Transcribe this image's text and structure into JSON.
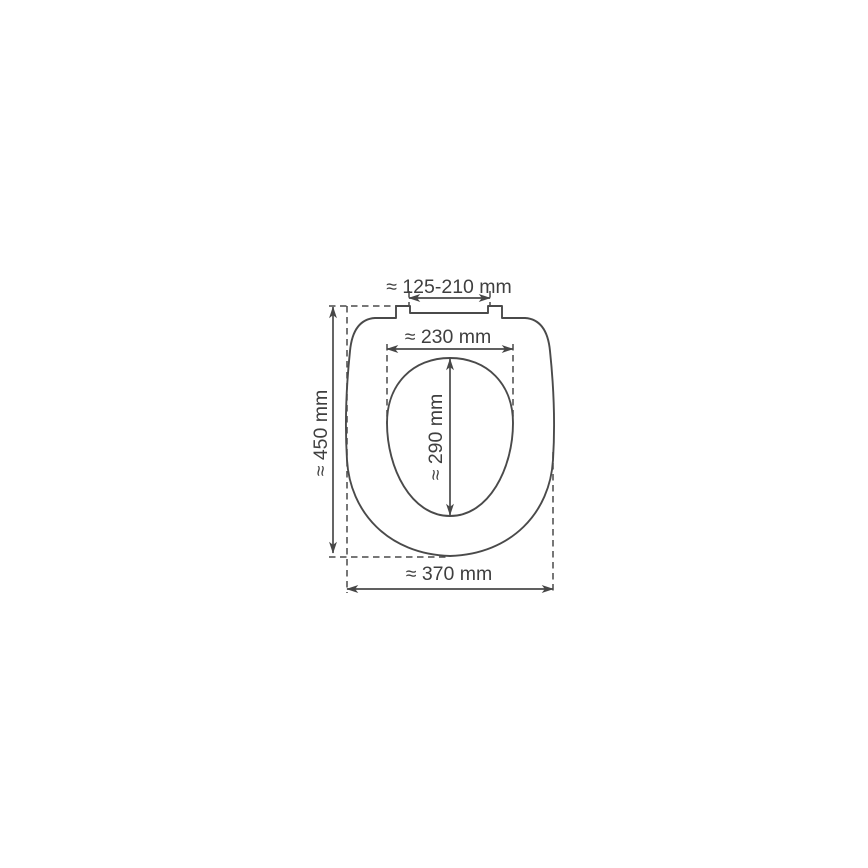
{
  "diagram": {
    "description": "Toilet seat dimension drawing, top view",
    "unit": "mm",
    "approx_symbol": "≈",
    "colors": {
      "line": "#4a4a4a",
      "text": "#3f3f3f",
      "background": "#ffffff"
    },
    "labels": {
      "hinge_spacing": "≈ 125-210 mm",
      "inner_width": "≈ 230 mm",
      "inner_length": "≈ 290 mm",
      "overall_length": "≈ 450 mm",
      "overall_width": "≈ 370 mm"
    },
    "measurements": {
      "hinge_spacing_mm": "125-210",
      "inner_width_mm": "230",
      "inner_length_mm": "290",
      "overall_length_mm": "450",
      "overall_width_mm": "370"
    }
  }
}
